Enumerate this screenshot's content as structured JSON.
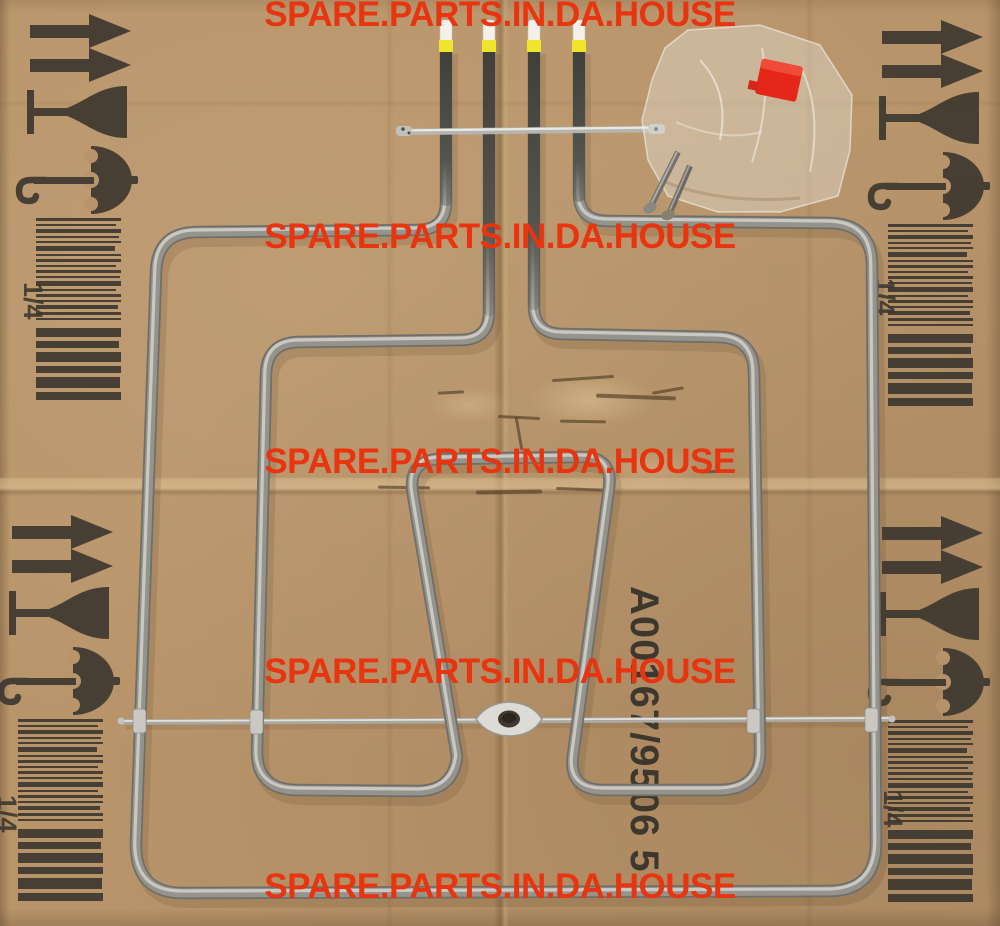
{
  "watermark": {
    "text": "SPARE.PARTS.IN.DA.HOUSE",
    "color": "#e8340f",
    "count": 5
  },
  "part_number": {
    "text": "A00167/9506 5"
  },
  "panel_label": {
    "text": "1/4"
  },
  "colors": {
    "cardboard": "#b8946a",
    "print": "#3b362e",
    "tube": "#94938c",
    "tube_highlight": "#c9c8c2",
    "terminal_dark": "#403f39",
    "terminal_band_yellow": "#efe52c",
    "insulator_white": "#f3f1ea",
    "red_part": "#e5271a"
  },
  "objects": {
    "element": "dual grill heating element",
    "icons": [
      "up-arrows-icon",
      "fragile-glass-icon",
      "keep-dry-umbrella-icon",
      "barcode",
      "support-rod",
      "eyelet-bracket",
      "mounting-bar",
      "terminal-tips",
      "plastic-bag",
      "screws",
      "red-part"
    ]
  }
}
